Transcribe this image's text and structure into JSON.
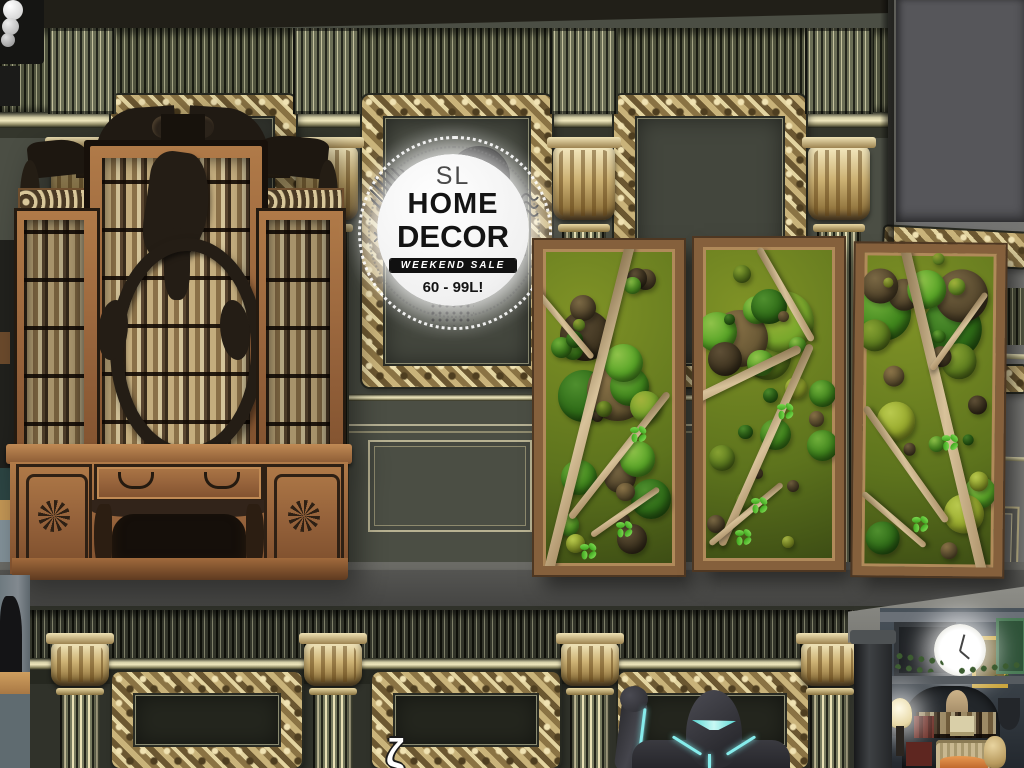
{
  "badge": {
    "brand_top": "SL",
    "brand_line1": "HOME",
    "brand_line2": "DECOR",
    "banner": "WEEKEND SALE",
    "price": "60 - 99L!"
  },
  "overlay": {
    "script_glyph": "ζ"
  },
  "colors": {
    "wall_upper": "#4b4e44",
    "wall_lower": "#30322a",
    "side_wall": "#6d6d6d",
    "gold_trim": "#c9b37a",
    "bookcase_wood": "#9a6238",
    "moss_frame_wood": "#85603c",
    "moss_green_bright": "#57a426",
    "moss_green_dark": "#2e6b17",
    "accent_cyan": "#86ecec",
    "badge_bg": "#ffffff",
    "badge_text": "#141414",
    "clock_glow": "#ffffff"
  }
}
